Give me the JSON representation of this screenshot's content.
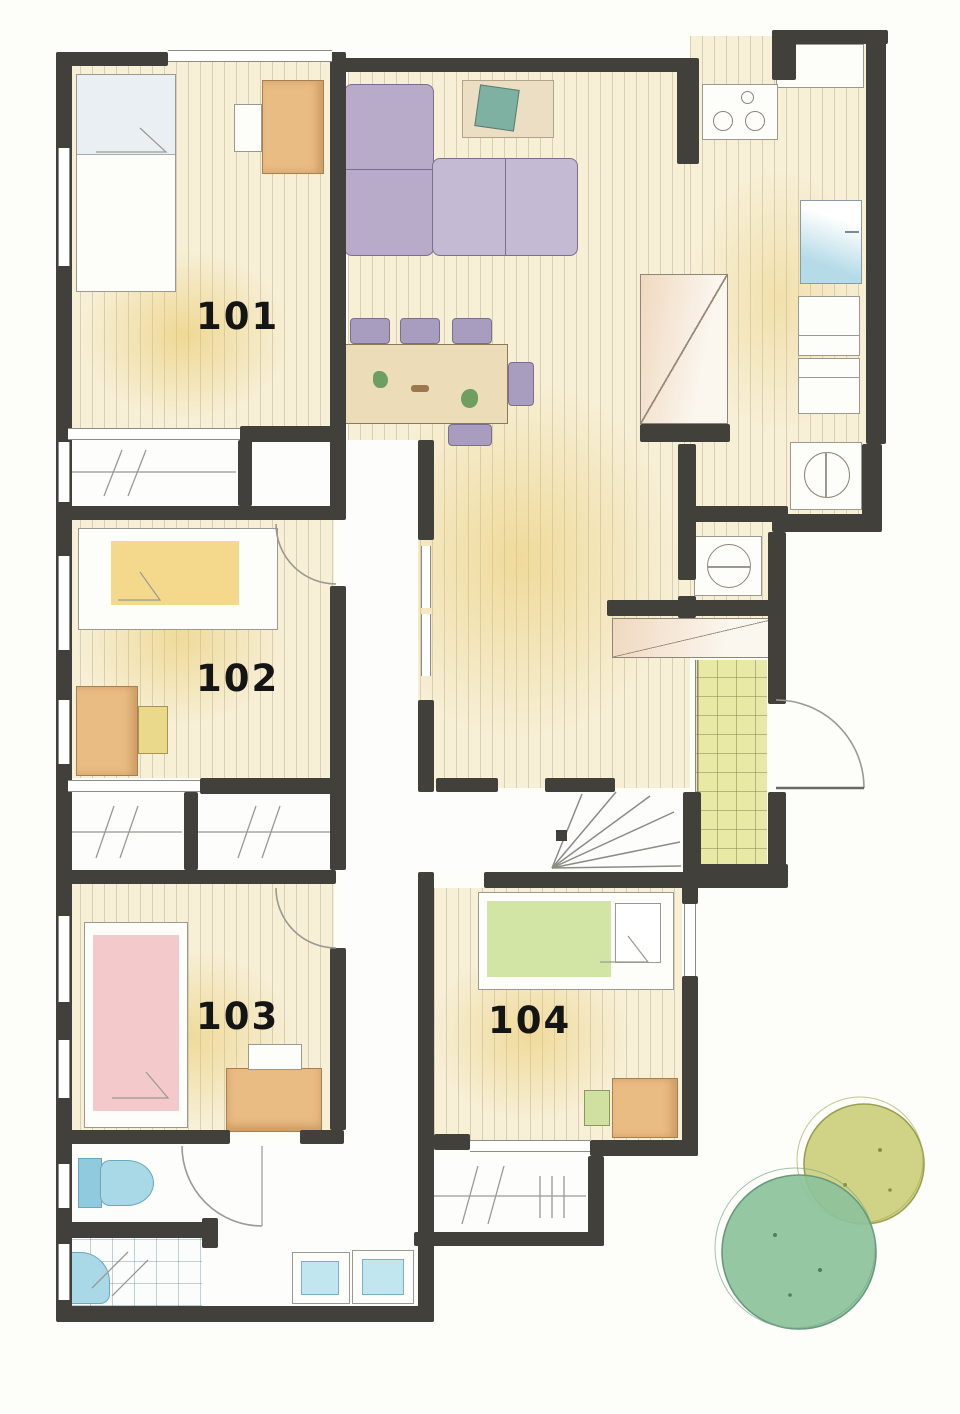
{
  "type": "hand-drawn watercolor floor plan",
  "rooms": [
    {
      "id": "room-101",
      "label": "101"
    },
    {
      "id": "room-102",
      "label": "102"
    },
    {
      "id": "room-103",
      "label": "103"
    },
    {
      "id": "room-104",
      "label": "104"
    }
  ],
  "palette": {
    "wall": "#42403a",
    "paper": "#fdfdfa",
    "wood_floor": "#f7efd6",
    "wood_stripe": "#7d6e48",
    "yellow_wash": "#e8c660",
    "sofa_purple": "#b7abc9",
    "chair_purple": "#a99dbf",
    "table_tan": "#ecdcb8",
    "desk_orange": "#e9bc84",
    "bed_yellow": "#f4d98d",
    "bed_pink": "#f3c9cb",
    "bed_green": "#d2e5a5",
    "water_blue": "#a9d8e6",
    "genkan_tile": "#e9e9a6",
    "tree_yellow": "#c9cd74",
    "tree_green": "#8dc29b",
    "plant_green": "#6f9e62",
    "cushion_teal": "#7fb1a3"
  }
}
